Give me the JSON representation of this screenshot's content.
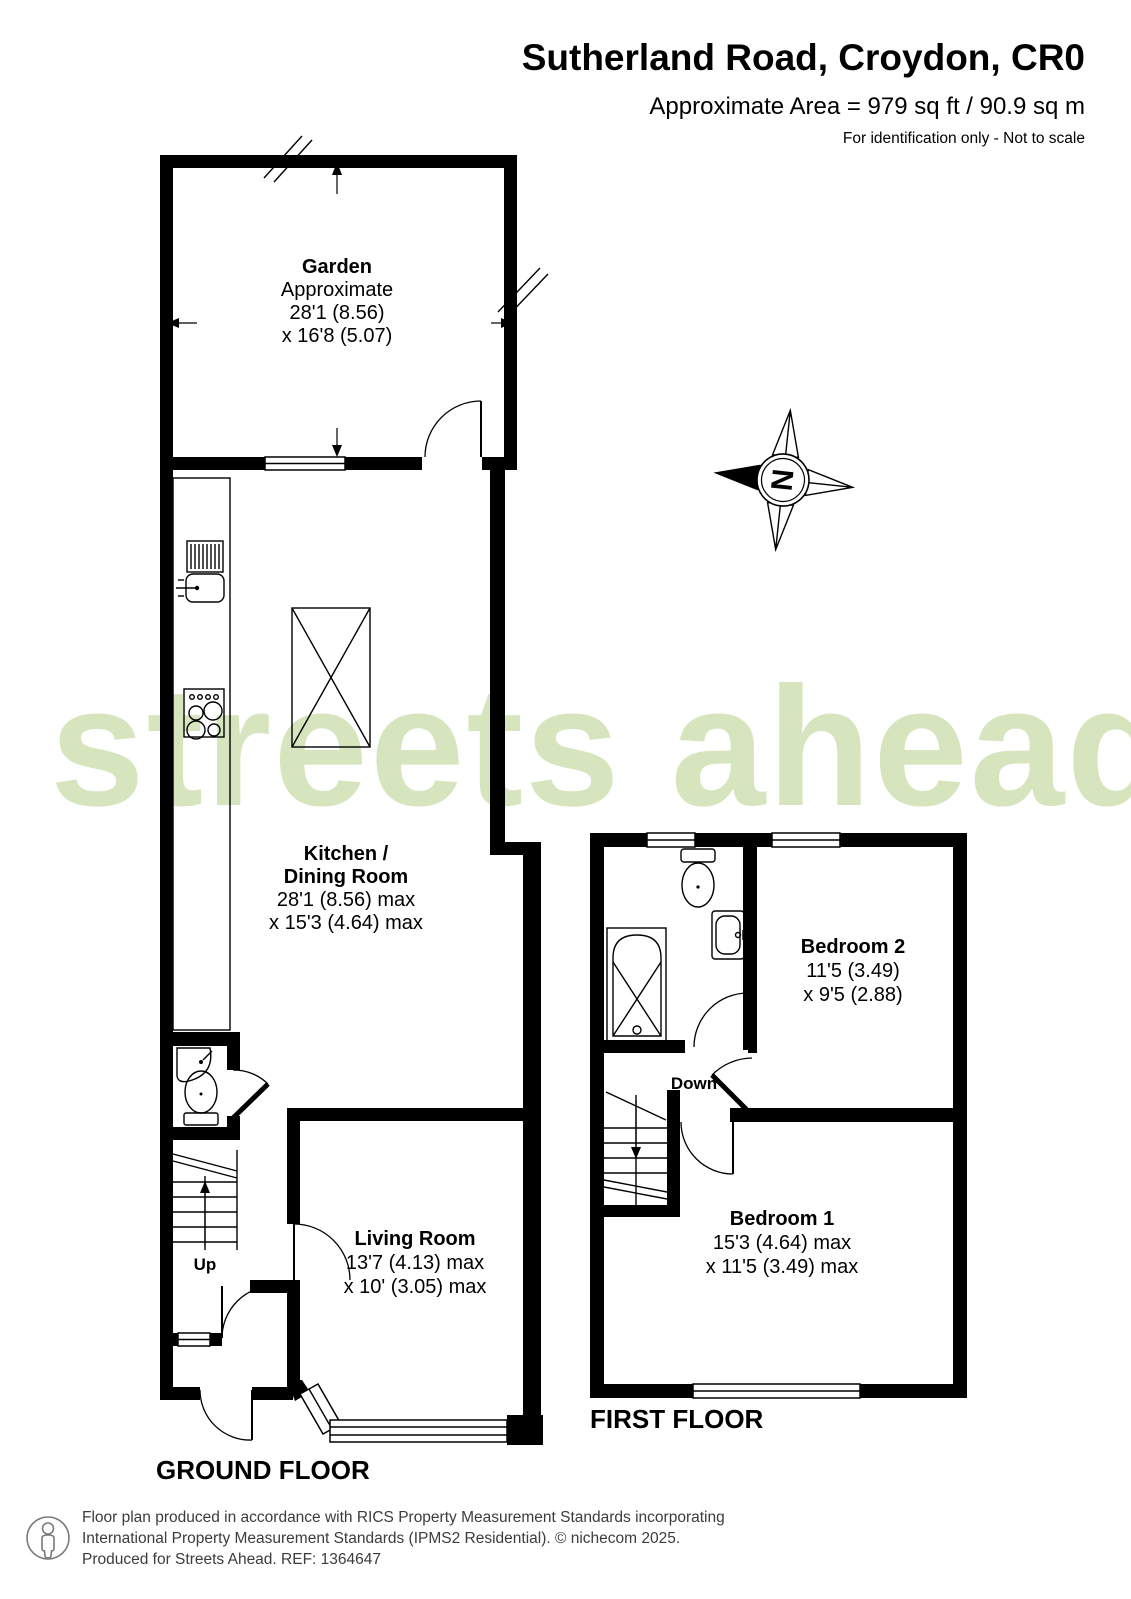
{
  "header": {
    "title": "Sutherland Road, Croydon, CR0",
    "area": "Approximate Area = 979 sq ft / 90.9 sq m",
    "disclaimer": "For identification only - Not to scale"
  },
  "watermark_text": "streets ahead",
  "compass": {
    "north_letter": "N"
  },
  "ground_floor": {
    "title": "GROUND FLOOR",
    "garden": {
      "name": "Garden",
      "line2": "Approximate",
      "line3": "28'1 (8.56)",
      "line4": "x 16'8 (5.07)"
    },
    "kitchen": {
      "name1": "Kitchen /",
      "name2": "Dining Room",
      "line3": "28'1 (8.56) max",
      "line4": "x 15'3 (4.64) max"
    },
    "living_room": {
      "name": "Living Room",
      "line2": "13'7 (4.13) max",
      "line3": "x 10' (3.05) max"
    },
    "stairs_label": "Up"
  },
  "first_floor": {
    "title": "FIRST FLOOR",
    "bedroom2": {
      "name": "Bedroom 2",
      "line2": "11'5 (3.49)",
      "line3": "x 9'5 (2.88)"
    },
    "bedroom1": {
      "name": "Bedroom 1",
      "line2": "15'3 (4.64) max",
      "line3": "x 11'5 (3.49) max"
    },
    "stairs_label": "Down"
  },
  "footer": {
    "line1": "Floor plan produced in accordance with RICS Property Measurement Standards incorporating",
    "line2": "International Property Measurement Standards (IPMS2 Residential).   © nichecom 2025.",
    "line3": "Produced for Streets Ahead.   REF:  1364647"
  },
  "colors": {
    "watermark": "#d7e5bf",
    "walls": "#000000",
    "footer_text": "#3c3c3c"
  }
}
